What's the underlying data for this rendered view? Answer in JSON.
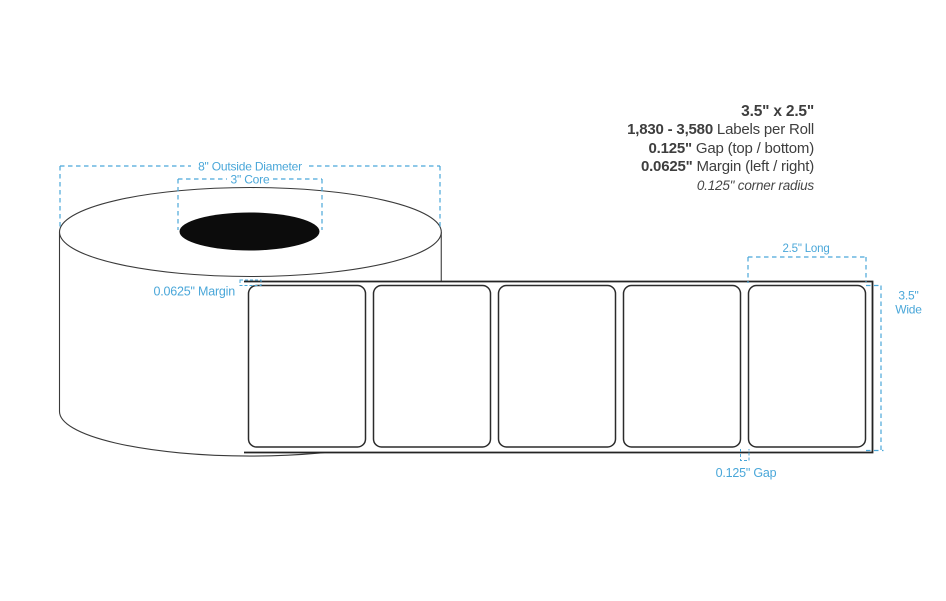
{
  "specs": {
    "size": "3.5\" x 2.5\"",
    "labels_value": "1,830 - 3,580",
    "labels_text": " Labels per Roll",
    "gap_value": "0.125\"",
    "gap_text": " Gap (top / bottom)",
    "margin_value": "0.0625\"",
    "margin_text": " Margin (left / right)",
    "corner_radius": "0.125\" corner radius"
  },
  "annotations": {
    "outside_diameter": "8\" Outside Diameter",
    "core": "3\" Core",
    "long": "2.5\" Long",
    "wide_line1": "3.5\"",
    "wide_line2": "Wide",
    "margin": "0.0625\" Margin",
    "gap": "0.125\" Gap"
  },
  "colors": {
    "dimension_blue": "#4aa7d9",
    "outline_dark": "#2b2b2b",
    "spec_text": "#3e3e3e",
    "core_black": "#0c0c0c"
  }
}
